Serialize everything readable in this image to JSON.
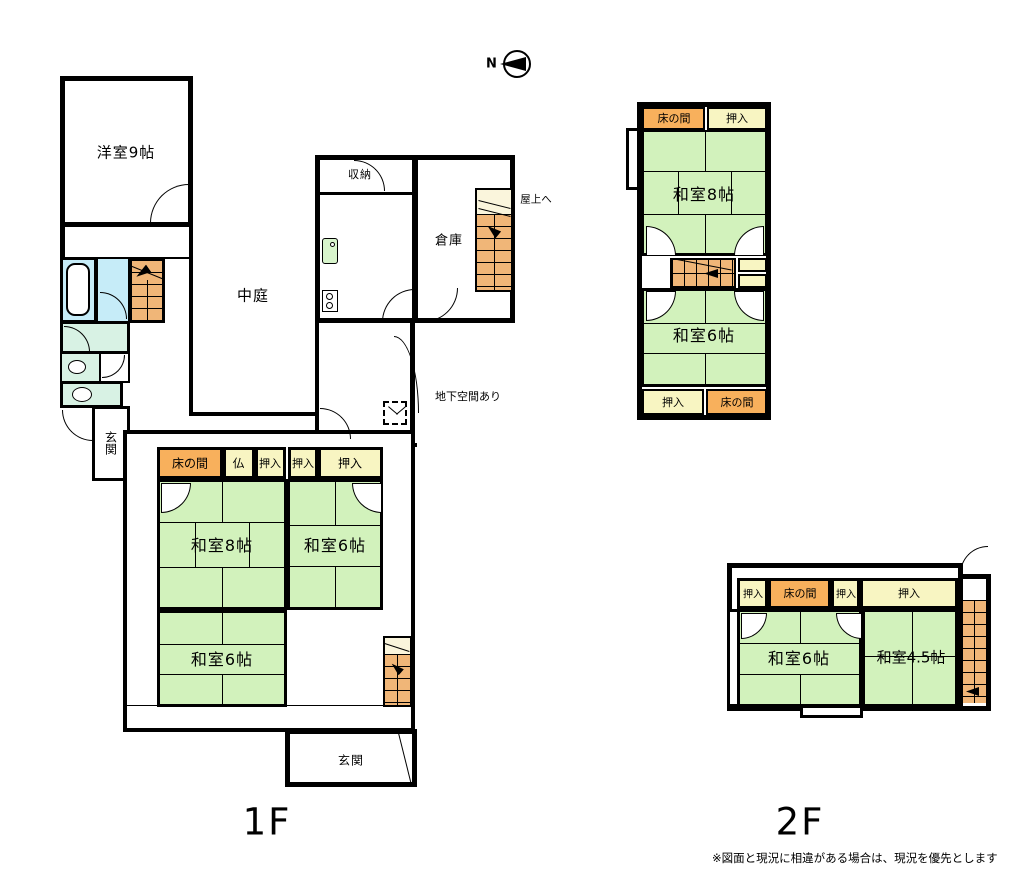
{
  "compass": {
    "north": "N"
  },
  "floor1": {
    "label": "1F",
    "rooms": {
      "yoshitsu9": "洋室9帖",
      "shuno": "収納",
      "nakaniwa": "中庭",
      "soko": "倉庫",
      "okujo_note": "屋上へ",
      "chika_note": "地下空間あり",
      "tokonoma": "床の間",
      "butsudan": "仏",
      "oshiire_a": "押入",
      "oshiire_b": "押入",
      "oshiire_c": "押入",
      "washitsu8": "和室8帖",
      "washitsu6_east": "和室6帖",
      "washitsu6_south": "和室6帖",
      "genkan_side": "玄関",
      "genkan": "玄関"
    }
  },
  "floor2": {
    "label": "2F",
    "north_block": {
      "tokonoma_n": "床の間",
      "oshiire_n": "押入",
      "washitsu8": "和室8帖",
      "washitsu6": "和室6帖",
      "oshiire_s": "押入",
      "tokonoma_s": "床の間"
    },
    "south_block": {
      "oshiire_1": "押入",
      "tokonoma": "床の間",
      "oshiire_2": "押入",
      "oshiire_3": "押入",
      "washitsu6": "和室6帖",
      "washitsu45": "和室4.5帖"
    }
  },
  "footnote": "※図面と現況に相違がある場合は、現況を優先とします",
  "palette": {
    "tatami": "#d2f2bc",
    "tokonoma": "#f8b05c",
    "closet": "#f8f5c2",
    "stairs": "#f0b678",
    "stairs_light": "#faf5dc",
    "bath": "#c6ecf8",
    "toilet": "#d8f2e4",
    "wall": "#000000"
  }
}
